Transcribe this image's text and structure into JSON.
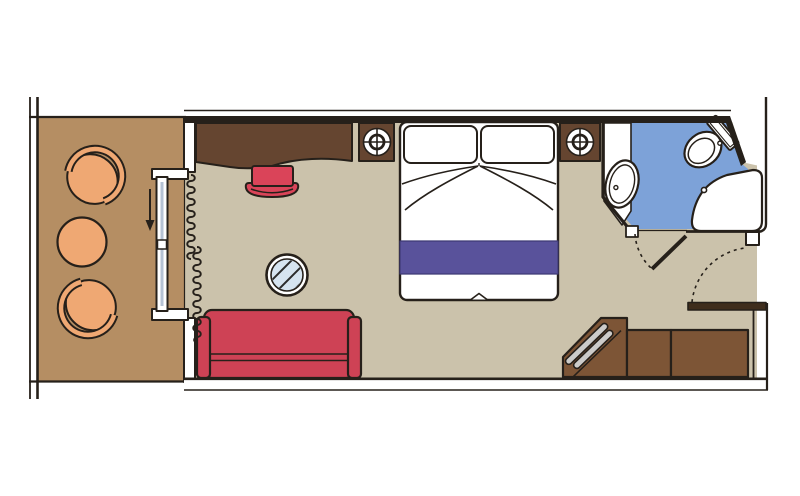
{
  "image_type": "cruise-ship-cabin-floor-plan",
  "colors": {
    "background": "#ffffff",
    "white": "#ffffff",
    "ink": "#26201a",
    "balcony_floor": "#b58e63",
    "balcony_furniture": "#efa873",
    "cabin_floor": "#cbc2ab",
    "dark_wood": "#654530",
    "medium_wood": "#7d5536",
    "door_leaf_wood": "#3f2d1c",
    "sofa_red": "#ce4255",
    "stool_red": "#da4459",
    "bed_runner_purple": "#59529b",
    "bathroom_floor_blue": "#7da2d8",
    "glass_blue": "#d6e4f0",
    "door_glass": "#b5c2d4",
    "metal_gray": "#cccbc9",
    "hatch_ink": "#2b2b2b"
  },
  "areas": {
    "balcony": {
      "items": [
        "armchair",
        "round-table",
        "armchair",
        "sliding-glass-door",
        "railing"
      ]
    },
    "cabin": {
      "items": [
        "desk",
        "stool",
        "bedside-table-left",
        "reading-lamp-left",
        "double-bed",
        "pillows",
        "bed-runner",
        "bedside-table-right",
        "reading-lamp-right",
        "glass-coffee-table",
        "sofa",
        "curtain",
        "vanity-desk",
        "luggage-bench",
        "wardrobe",
        "entrance-door"
      ]
    },
    "bathroom": {
      "items": [
        "washbasin",
        "toilet",
        "shower",
        "bathroom-door"
      ]
    }
  }
}
